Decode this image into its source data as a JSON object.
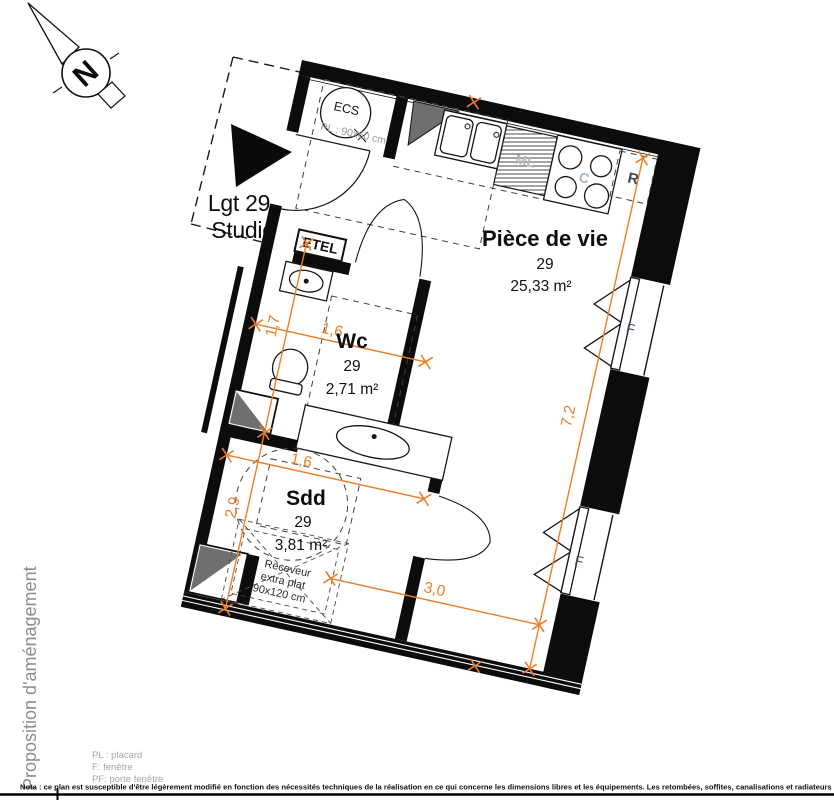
{
  "compass": {
    "letter": "N"
  },
  "unit": {
    "line1": "Lgt 29",
    "line2": "Studio"
  },
  "rooms": {
    "living": {
      "name": "Pièce de vie",
      "number": "29",
      "area": "25,33 m²"
    },
    "wc": {
      "name": "Wc",
      "number": "29",
      "area": "2,71 m²"
    },
    "sdd": {
      "name": "Sdd",
      "number": "29",
      "area": "3,81 m²"
    }
  },
  "fixtures": {
    "ecs": "ECS",
    "closet": "PL : 90x60 cm",
    "etel": "ETEL",
    "fridge": "R",
    "cooktop": "C",
    "washer": "ML",
    "window": "F",
    "shower": {
      "l1": "Receveur",
      "l2": "extra plat",
      "l3": "90x120 cm"
    }
  },
  "dimensions": {
    "wc_height": "1,7",
    "wc_width": "1,6",
    "sdd_width": "1,6",
    "sdd_height": "2,9",
    "living_height": "7,2",
    "living_width": "3,0"
  },
  "footer": {
    "vertical_title": "Proposition d'aménagement",
    "legend": {
      "pl": "PL : placard",
      "f": "F: fenêtre",
      "pf": "PF: porte fenêtre"
    },
    "nota": "Nota : ce plan est susceptible d'être légèrement modifié en fonction des nécessités techniques de la réalisation en ce qui concerne les dimensions libres et les équipements. Les retombées, soffites, canalisations et radiateurs ne sont pas figurés."
  },
  "colors": {
    "dimension": "#ee7d27",
    "wall": "#0c0c0c",
    "gray_text": "#9a9a9a",
    "blue_label": "#3a4a5e",
    "light_blue": "#9fb6d0"
  }
}
